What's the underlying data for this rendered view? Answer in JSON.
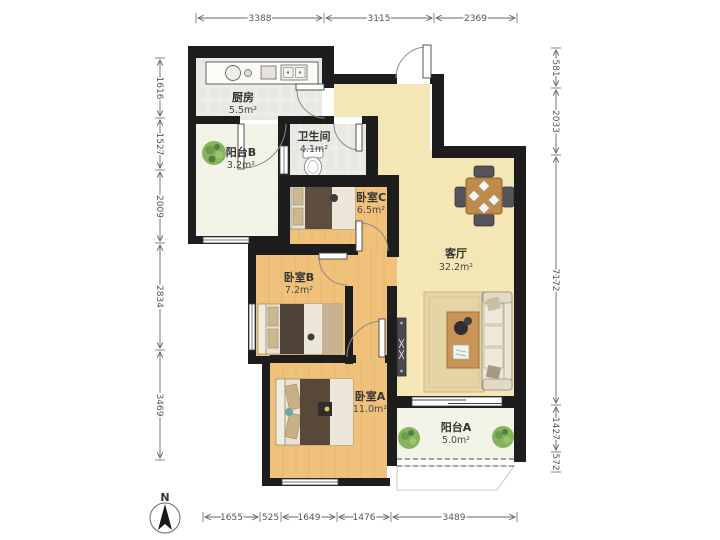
{
  "plan": {
    "rooms": [
      {
        "id": "kitchen",
        "name": "厨房",
        "area": "5.5m²"
      },
      {
        "id": "balcony-b",
        "name": "阳台B",
        "area": "3.2m²"
      },
      {
        "id": "bathroom",
        "name": "卫生间",
        "area": "4.1m²"
      },
      {
        "id": "bedroom-c",
        "name": "卧室C",
        "area": "6.5m²"
      },
      {
        "id": "bedroom-b",
        "name": "卧室B",
        "area": "7.2m²"
      },
      {
        "id": "bedroom-a",
        "name": "卧室A",
        "area": "11.0m²"
      },
      {
        "id": "living",
        "name": "客厅",
        "area": "32.2m²"
      },
      {
        "id": "balcony-a",
        "name": "阳台A",
        "area": "5.0m²"
      }
    ],
    "dimensions": {
      "top": [
        "3388",
        "3115",
        "2369"
      ],
      "left": [
        "1616",
        "1527",
        "2009",
        "2834",
        "3469"
      ],
      "right": [
        "581",
        "2033",
        "7172",
        "1427",
        "572"
      ],
      "bottom": [
        "1655",
        "525",
        "1649",
        "1476",
        "3489"
      ]
    },
    "compass": {
      "label": "N"
    },
    "colors": {
      "wall": "#1d1d1d",
      "living_floor": "#f5e6b6",
      "wood_floor": "#efc17b",
      "tile_floor": "#e8e9e3",
      "balcony_floor": "#f0f3e5",
      "dimension_text": "#555555",
      "plant": "#85b45c",
      "bed_dark": "#57483a",
      "table_wood": "#c08a4a"
    }
  }
}
